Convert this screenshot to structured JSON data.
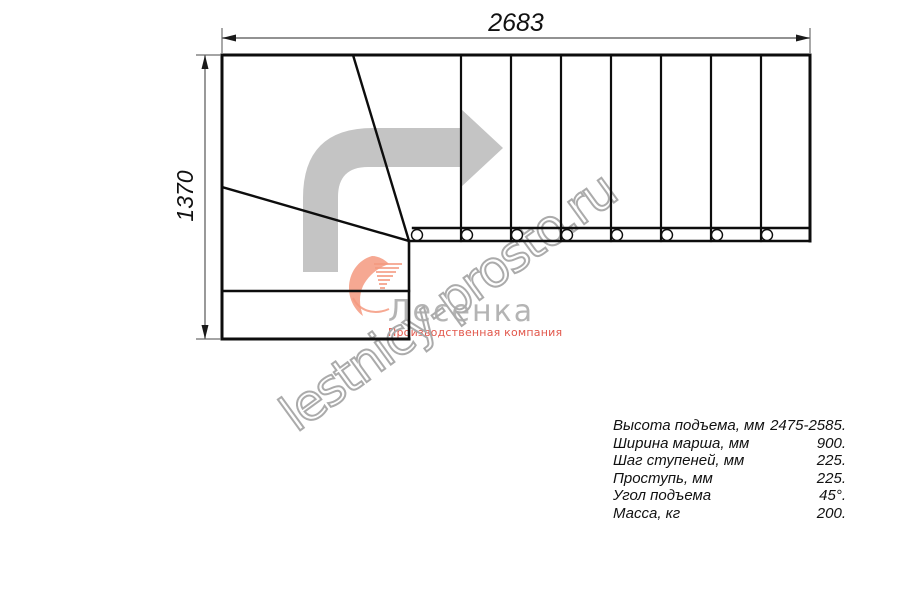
{
  "drawing": {
    "title": "stair-plan-top-view",
    "dim_width_label": "2683",
    "dim_height_label": "1370",
    "straight_treads": 8,
    "winder_steps": 3,
    "line_color": "#0d0d0d",
    "dim_line_color": "#6e6e6e",
    "arrow_color": "#c4c4c4"
  },
  "watermark": {
    "text": "lestnicy-prosto.ru",
    "outline_color": "#ababab"
  },
  "logo": {
    "name": "Лесенка",
    "subtitle": "Производственная компания",
    "name_color": "#b4b4b4",
    "subtitle_color": "#e2574b",
    "swoosh_color": "#f4997f"
  },
  "specs": {
    "rows": [
      {
        "label": "Высота подъема, мм",
        "value": "2475-2585."
      },
      {
        "label": "Ширина марша, мм",
        "value": "900."
      },
      {
        "label": "Шаг ступеней, мм",
        "value": "225."
      },
      {
        "label": "Проступь, мм",
        "value": "225."
      },
      {
        "label": "Угол подъема",
        "value": "45°."
      },
      {
        "label": "Масса, кг",
        "value": "200."
      }
    ]
  }
}
